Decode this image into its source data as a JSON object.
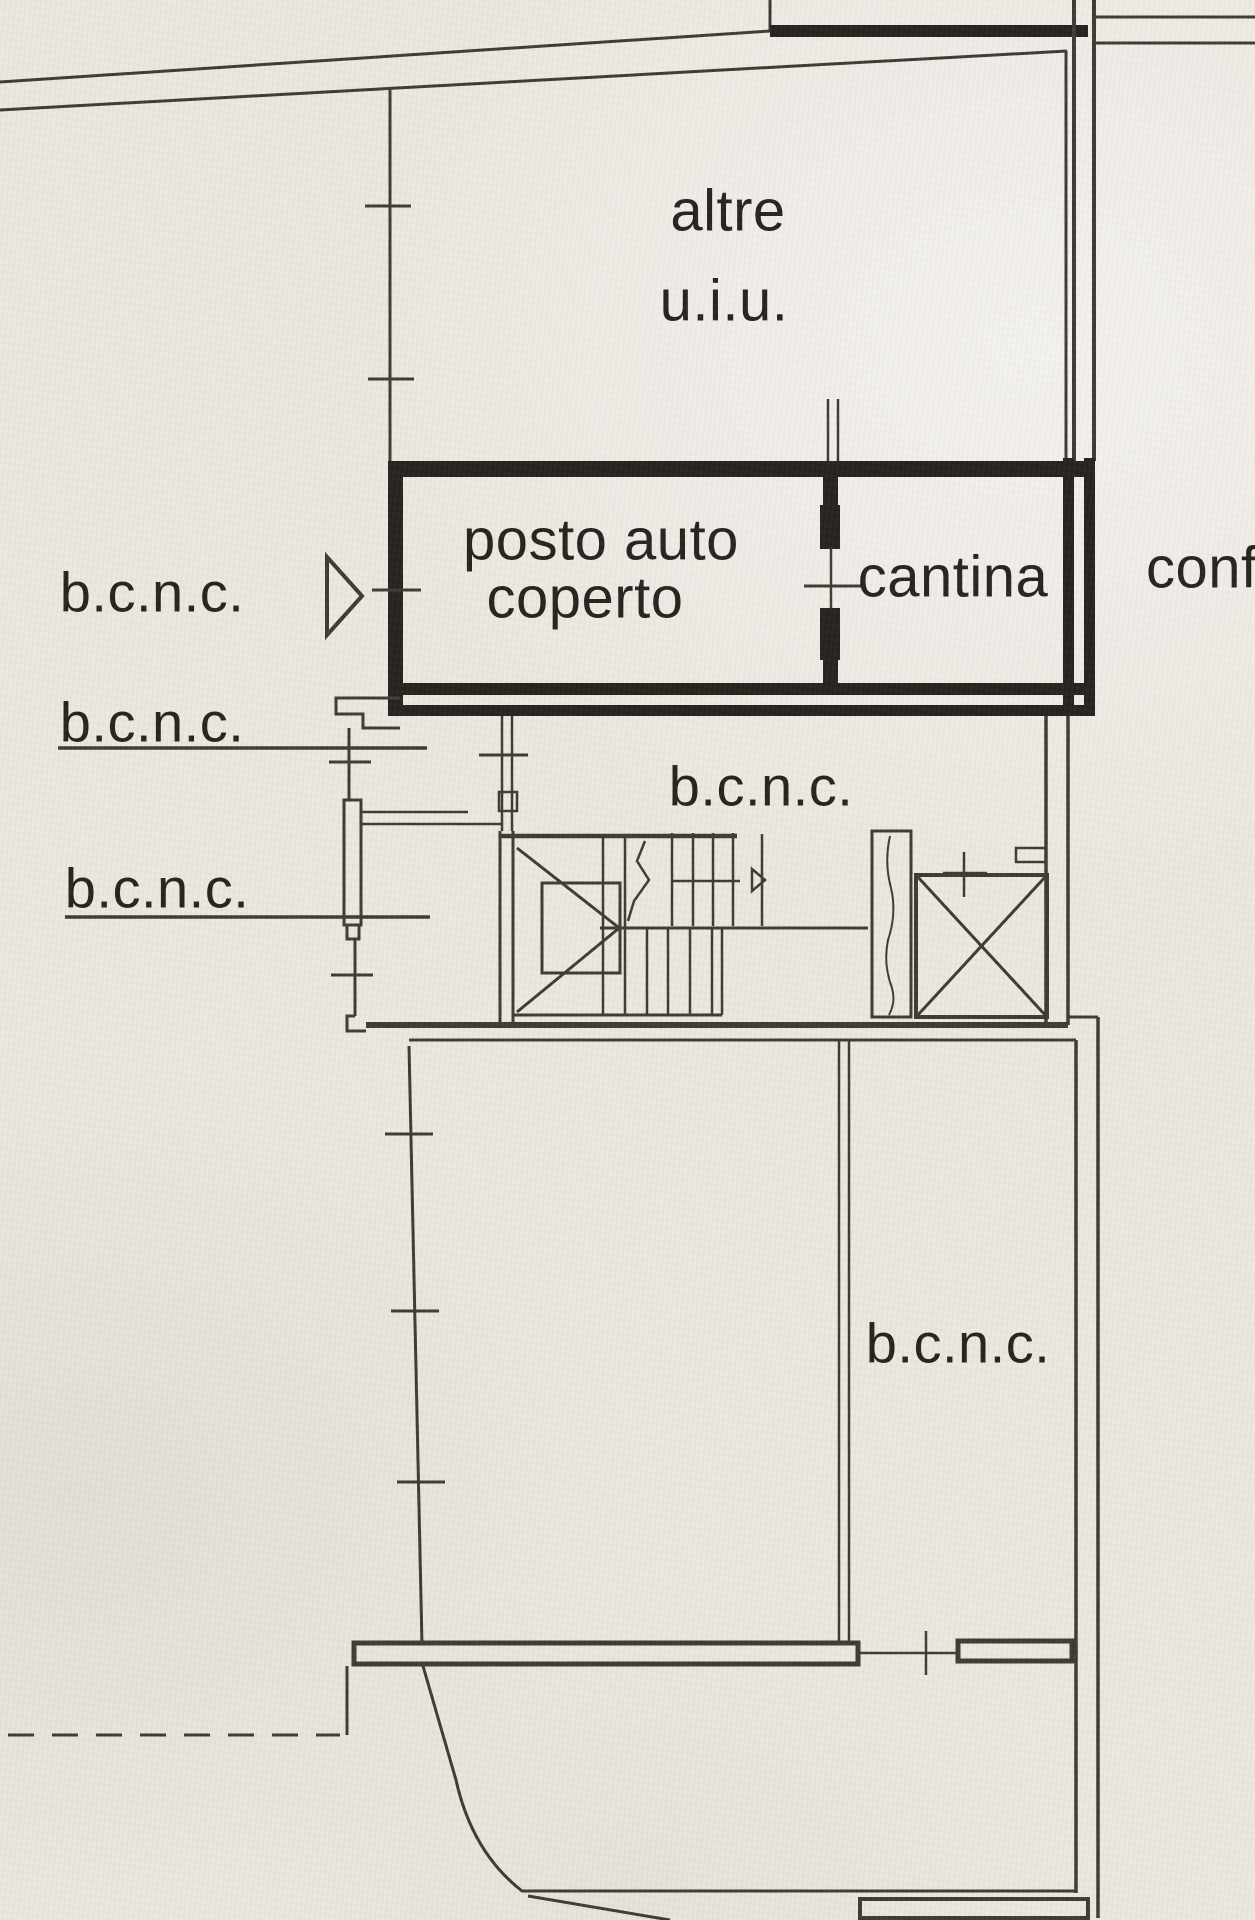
{
  "plan": {
    "colors": {
      "paper": "#ebe7e0",
      "ink": "#3a362f",
      "ink_strong": "#211e19"
    },
    "labels": {
      "altre_line1": "altre",
      "altre_line2": "u.i.u.",
      "carport_line1": "posto auto",
      "carport_line2": "coperto",
      "cantina": "cantina",
      "bcnc_left_top": "b.c.n.c.",
      "bcnc_left_mid": "b.c.n.c.",
      "bcnc_left_bottom": "b.c.n.c.",
      "bcnc_center": "b.c.n.c.",
      "bcnc_bottom_room": "b.c.n.c.",
      "conf_edge": "conf"
    }
  }
}
